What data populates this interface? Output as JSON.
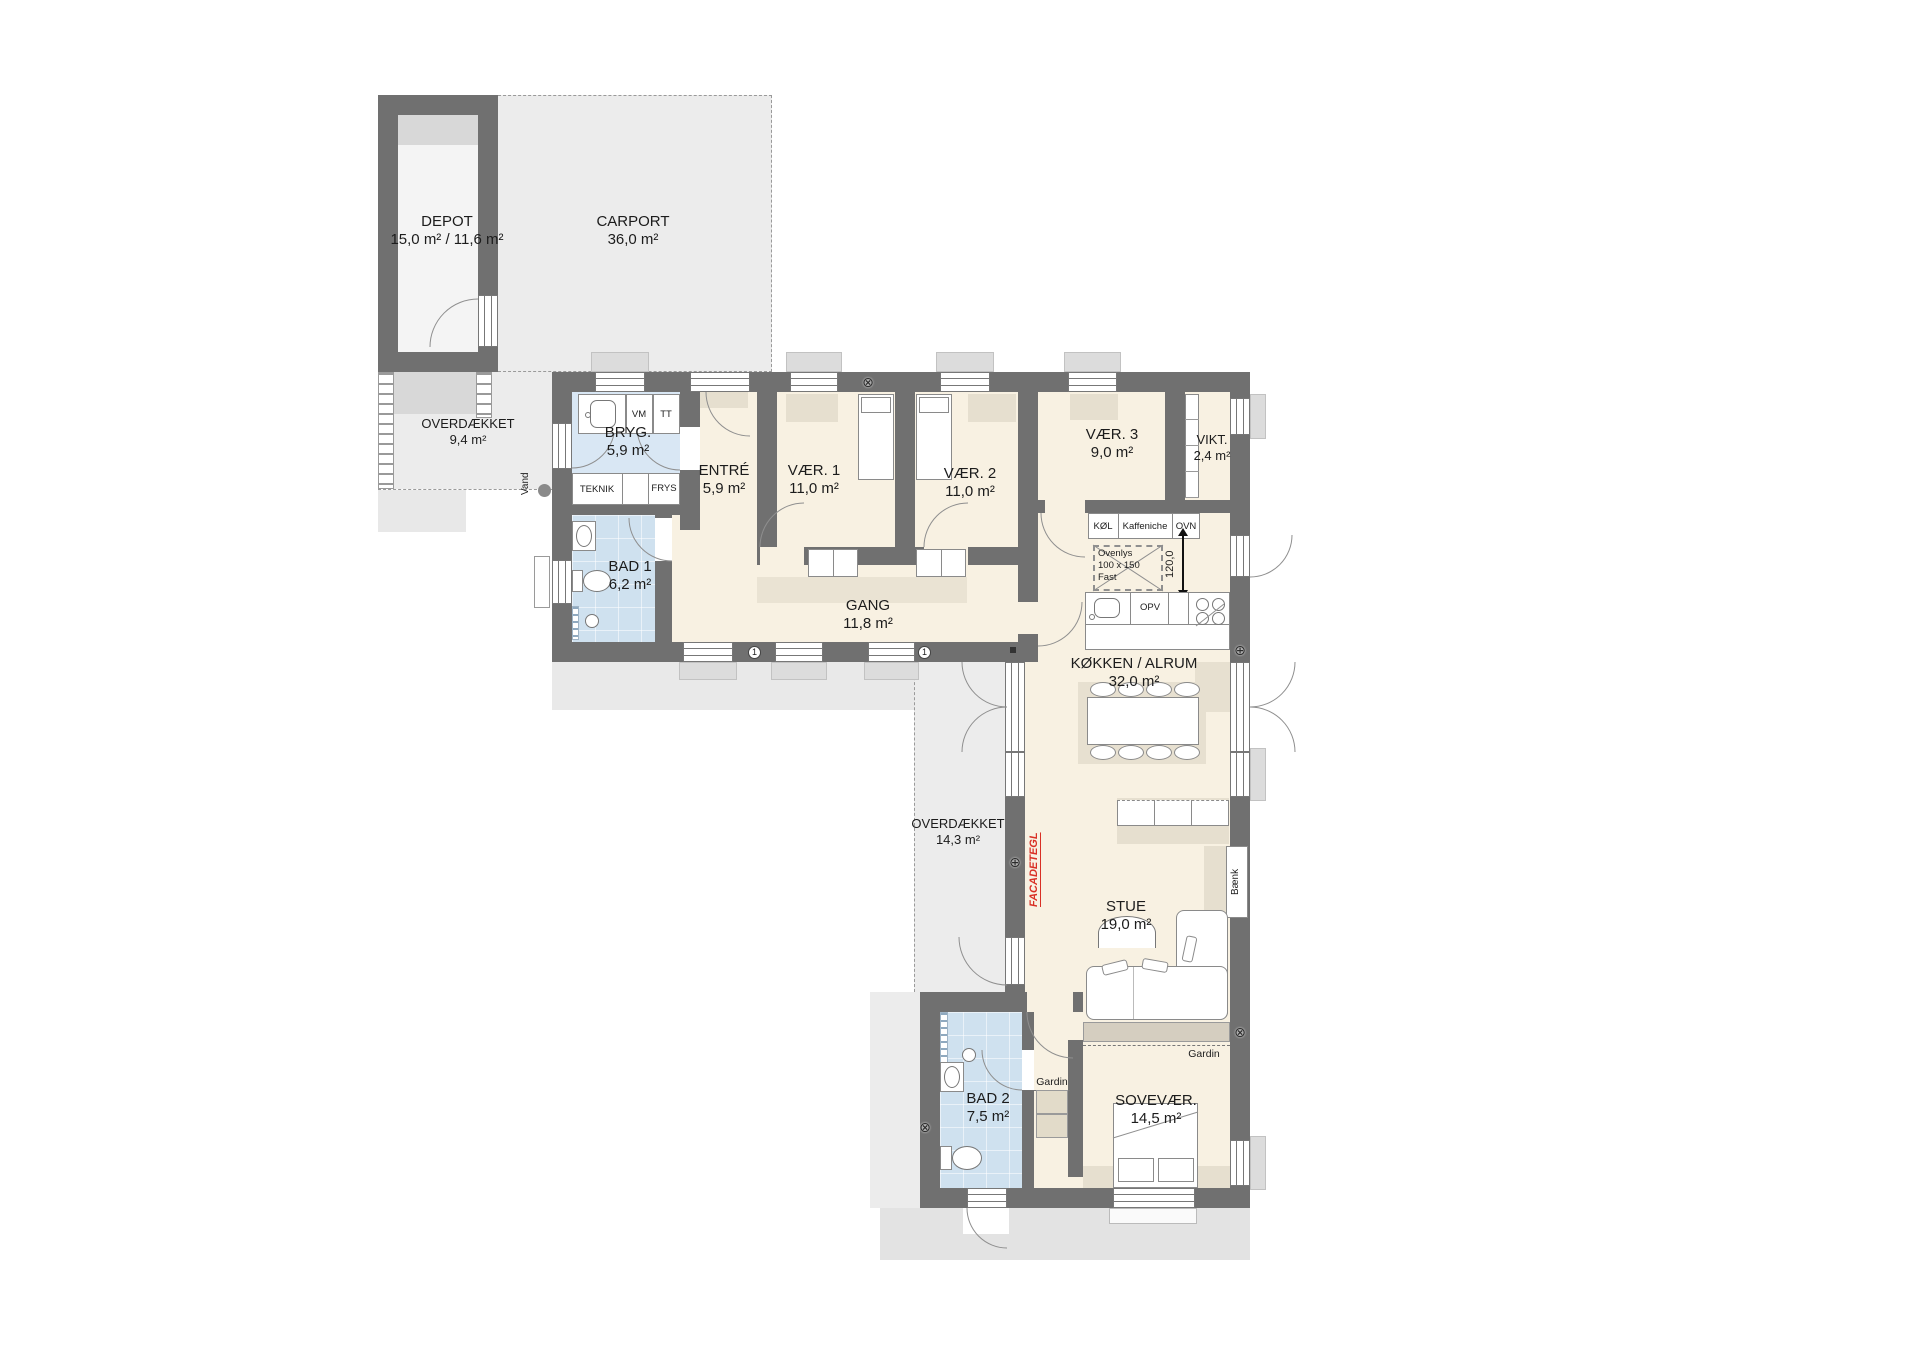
{
  "rooms": {
    "depot": {
      "name": "DEPOT",
      "area": "15,0 m² / 11,6 m²"
    },
    "carport": {
      "name": "CARPORT",
      "area": "36,0 m²"
    },
    "overdaekket_nw": {
      "name": "OVERDÆKKET",
      "area": "9,4 m²"
    },
    "bryggers": {
      "name": "BRYG.",
      "area": "5,9 m²"
    },
    "entre": {
      "name": "ENTRÉ",
      "area": "5,9 m²"
    },
    "vaer1": {
      "name": "VÆR. 1",
      "area": "11,0 m²"
    },
    "vaer2": {
      "name": "VÆR. 2",
      "area": "11,0 m²"
    },
    "vaer3": {
      "name": "VÆR. 3",
      "area": "9,0 m²"
    },
    "vikt": {
      "name": "VIKT.",
      "area": "2,4 m²"
    },
    "bad1": {
      "name": "BAD 1",
      "area": "6,2 m²"
    },
    "gang": {
      "name": "GANG",
      "area": "11,8 m²"
    },
    "koekken": {
      "name": "KØKKEN / ALRUM",
      "area": "32,0 m²"
    },
    "overdaekket_w": {
      "name": "OVERDÆKKET",
      "area": "14,3 m²"
    },
    "stue": {
      "name": "STUE",
      "area": "19,0 m²"
    },
    "bad2": {
      "name": "BAD 2",
      "area": "7,5 m²"
    },
    "sovevaer": {
      "name": "SOVEVÆR.",
      "area": "14,5 m²"
    }
  },
  "appliances": {
    "vm": "VM",
    "tt": "TT",
    "teknik": "TEKNIK",
    "frys": "FRYS",
    "koel": "KØL",
    "kaffeniche": "Kaffeniche",
    "ovn": "OVN",
    "opv": "OPV"
  },
  "annotations": {
    "vand": "Vand",
    "skylight_line1": "Ovenlys",
    "skylight_line2": "100 x 150",
    "skylight_line3": "Fast",
    "dim_kitchen": "120,0",
    "facade": "FACADETEGL",
    "baenk": "Bænk",
    "gardin": "Gardin",
    "wall_mark": "1"
  },
  "colors": {
    "wall": "#707070",
    "floor": "#f8f1e2",
    "tile": "#cfe1ef",
    "outdoor": "#ececec",
    "accent_red": "#d93025"
  }
}
